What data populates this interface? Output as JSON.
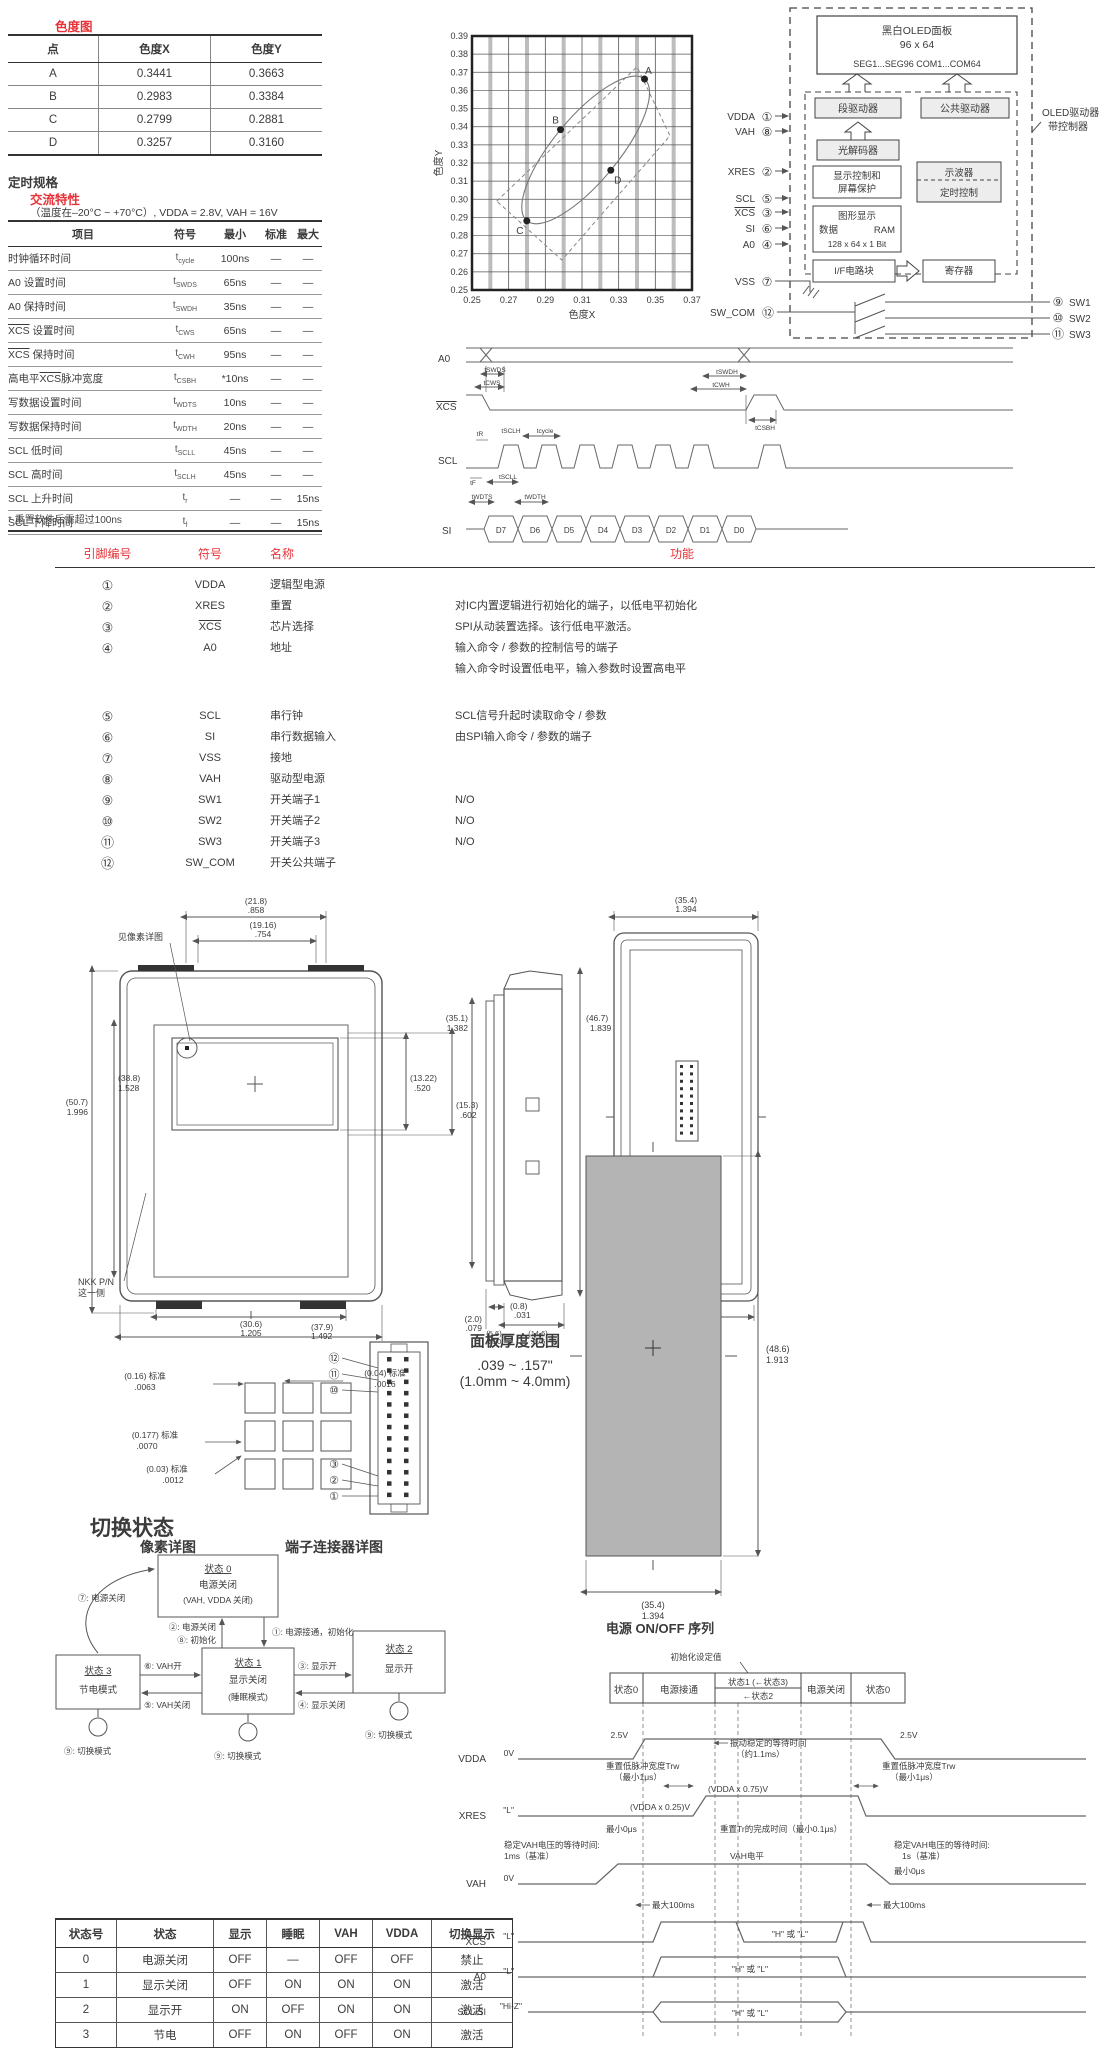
{
  "colors": {
    "accent_red": "#e63238",
    "text": "#3b3b3b",
    "panel_gray": "#b4b4b4"
  },
  "chroma": {
    "title": "色度图",
    "table": {
      "headers": [
        "点",
        "色度X",
        "色度Y"
      ],
      "rows": [
        [
          "A",
          "0.3441",
          "0.3663"
        ],
        [
          "B",
          "0.2983",
          "0.3384"
        ],
        [
          "C",
          "0.2799",
          "0.2881"
        ],
        [
          "D",
          "0.3257",
          "0.3160"
        ]
      ]
    }
  },
  "chart_data": {
    "type": "scatter",
    "title": "",
    "xlabel": "色度X",
    "ylabel": "色度Y",
    "xlim": [
      0.25,
      0.37
    ],
    "ylim": [
      0.25,
      0.39
    ],
    "x_tick_labels": [
      "0.25",
      "0.27",
      "0.29",
      "0.31",
      "0.33",
      "0.35",
      "0.37"
    ],
    "y_tick_start": 0.25,
    "y_tick_step": 0.01,
    "y_tick_count": 15,
    "grid": true,
    "legend": false,
    "points": [
      {
        "label": "A",
        "x": 0.3441,
        "y": 0.3663
      },
      {
        "label": "B",
        "x": 0.2983,
        "y": 0.3384
      },
      {
        "label": "C",
        "x": 0.2799,
        "y": 0.2881
      },
      {
        "label": "D",
        "x": 0.3257,
        "y": 0.316
      }
    ],
    "dashed_region": [
      [
        0.2635,
        0.299
      ],
      [
        0.34,
        0.373
      ],
      [
        0.358,
        0.335
      ],
      [
        0.299,
        0.2665
      ]
    ]
  },
  "timing": {
    "heading": "定时规格",
    "subheading": "交流特性",
    "condition": "（温度在–20°C ~ +70°C）, VDDA = 2.8V, VAH = 16V",
    "headers": [
      "项目",
      "符号",
      "最小",
      "标准",
      "最大"
    ],
    "rows": [
      {
        "item": "时钟循环时间",
        "sym": [
          "t",
          "cycle"
        ],
        "min": "100ns",
        "std": "—",
        "max": "—"
      },
      {
        "item": "A0 设置时间",
        "sym": [
          "t",
          "SWDS"
        ],
        "min": "65ns",
        "std": "—",
        "max": "—"
      },
      {
        "item": "A0 保持时间",
        "sym": [
          "t",
          "SWDH"
        ],
        "min": "35ns",
        "std": "—",
        "max": "—"
      },
      {
        "item": "{XCS} 设置时间",
        "sym": [
          "t",
          "CWS"
        ],
        "min": "65ns",
        "std": "—",
        "max": "—"
      },
      {
        "item": "{XCS} 保持时间",
        "sym": [
          "t",
          "CWH"
        ],
        "min": "95ns",
        "std": "—",
        "max": "—"
      },
      {
        "item": "高电平{XCS}脉冲宽度",
        "sym": [
          "t",
          "CSBH"
        ],
        "min": "*10ns",
        "std": "—",
        "max": "—"
      },
      {
        "item": "写数据设置时间",
        "sym": [
          "t",
          "WDTS"
        ],
        "min": "10ns",
        "std": "—",
        "max": "—"
      },
      {
        "item": "写数据保持时间",
        "sym": [
          "t",
          "WDTH"
        ],
        "min": "20ns",
        "std": "—",
        "max": "—"
      },
      {
        "item": "SCL 低时间",
        "sym": [
          "t",
          "SCLL"
        ],
        "min": "45ns",
        "std": "—",
        "max": "—"
      },
      {
        "item": "SCL 高时间",
        "sym": [
          "t",
          "SCLH"
        ],
        "min": "45ns",
        "std": "—",
        "max": "—"
      },
      {
        "item": "SCL 上升时间",
        "sym": [
          "t",
          "r"
        ],
        "min": "—",
        "std": "—",
        "max": "15ns"
      },
      {
        "item": "SCL 下降时间",
        "sym": [
          "t",
          "f"
        ],
        "min": "—",
        "std": "—",
        "max": "15ns"
      }
    ],
    "footnote": "* 重置软件后需超过100ns"
  },
  "waveform": {
    "sig": {
      "a0": "A0",
      "xcs": "XCS",
      "scl": "SCL",
      "si": "SI"
    },
    "t": {
      "swds": "tSWDS",
      "cws": "tCWS",
      "swdh": "tSWDH",
      "cwh": "tCWH",
      "csbh": "tCSBH",
      "tr": "tR",
      "sclh": "tSCLH",
      "tcycle": "tcycle",
      "tf": "tF",
      "scll": "tSCLL",
      "wdts": "tWDTS",
      "wdth": "tWDTH"
    },
    "data": [
      "D7",
      "D6",
      "D5",
      "D4",
      "D3",
      "D2",
      "D1",
      "D0"
    ]
  },
  "block": {
    "panel1": "黑白OLED面板",
    "panel2": "96 x 64",
    "panel3": "SEG1...SEG96   COM1...COM64",
    "seg": "段驱动器",
    "com": "公共驱动器",
    "dec": "光解码器",
    "dc1": "显示控制和",
    "dc2": "屏幕保护",
    "osc": "示波器",
    "tc": "定时控制",
    "ram1": "图形显示",
    "ram2a": "数据",
    "ram2b": "RAM",
    "ram3": "128 x 64 x 1 Bit",
    "ifb": "I/F电路块",
    "reg": "寄存器",
    "ctrl1": "OLED驱动器",
    "ctrl2": "带控制器",
    "pins": {
      "vdda": "VDDA",
      "n1": "①",
      "vah": "VAH",
      "n8": "⑧",
      "xres": "XRES",
      "n2": "②",
      "scl": "SCL",
      "n5": "⑤",
      "xcs": "XCS",
      "n3": "③",
      "si": "SI",
      "n6": "⑥",
      "a0": "A0",
      "n4": "④",
      "vss": "VSS",
      "n7": "⑦",
      "swcom": "SW_COM",
      "n12": "⑫",
      "n9": "⑨",
      "sw1": "SW1",
      "n10": "⑩",
      "sw2": "SW2",
      "n11": "⑪",
      "sw3": "SW3"
    }
  },
  "pins": {
    "headers": [
      "引脚编号",
      "符号",
      "名称",
      "功能"
    ],
    "rows": [
      {
        "num": "①",
        "sym": "VDDA",
        "ovl": false,
        "name": "逻辑型电源",
        "func": []
      },
      {
        "num": "②",
        "sym": "XRES",
        "ovl": false,
        "name": "重置",
        "func": [
          "对IC内置逻辑进行初始化的端子，以低电平初始化"
        ]
      },
      {
        "num": "③",
        "sym": "XCS",
        "ovl": true,
        "name": "芯片选择",
        "func": [
          "SPI从动装置选择。该行低电平激活。"
        ]
      },
      {
        "num": "④",
        "sym": "A0",
        "ovl": false,
        "name": "地址",
        "func": [
          "输入命令 / 参数的控制信号的端子",
          "输入命令时设置低电平，输入参数时设置高电平"
        ]
      },
      {
        "num": "⑤",
        "sym": "SCL",
        "ovl": false,
        "name": "串行钟",
        "func": [
          "SCL信号升起时读取命令 / 参数"
        ],
        "gap": true
      },
      {
        "num": "⑥",
        "sym": "SI",
        "ovl": false,
        "name": "串行数据输入",
        "func": [
          "由SPI输入命令 / 参数的端子"
        ]
      },
      {
        "num": "⑦",
        "sym": "VSS",
        "ovl": false,
        "name": "接地",
        "func": []
      },
      {
        "num": "⑧",
        "sym": "VAH",
        "ovl": false,
        "name": "驱动型电源",
        "func": []
      },
      {
        "num": "⑨",
        "sym": "SW1",
        "ovl": false,
        "name": "开关端子1",
        "func": [
          "N/O"
        ]
      },
      {
        "num": "⑩",
        "sym": "SW2",
        "ovl": false,
        "name": "开关端子2",
        "func": [
          "N/O"
        ]
      },
      {
        "num": "⑪",
        "sym": "SW3",
        "ovl": false,
        "name": "开关端子3",
        "func": [
          "N/O"
        ]
      },
      {
        "num": "⑫",
        "sym": "SW_COM",
        "ovl": false,
        "name": "开关公共端子",
        "func": []
      }
    ]
  },
  "mech": {
    "top1": [
      "(21.8)",
      ".858"
    ],
    "top2": [
      "(19.16)",
      ".754"
    ],
    "see_pixel": "见像素详图",
    "left1": [
      "(50.7)",
      "1.996"
    ],
    "left2": [
      "(38.8)",
      "1.528"
    ],
    "right1": [
      "(13.22)",
      ".520"
    ],
    "right2": [
      "(15.3)",
      ".602"
    ],
    "bot1": [
      "(30.6)",
      "1.205"
    ],
    "bot2": [
      "(37.9)",
      "1.492"
    ],
    "nkk1": "NKK P/N",
    "nkk2": "这一侧",
    "sleft": [
      "(35.1)",
      "1.382"
    ],
    "sright": [
      "(46.7)",
      "1.839"
    ],
    "sb1": [
      "(0.8)",
      ".031"
    ],
    "sb2": [
      "(2.0)",
      ".079"
    ],
    "sb3": [
      "(5.6)",
      ".220"
    ],
    "sb4": [
      "(14.6)",
      ".575"
    ],
    "btop": [
      "(35.4)",
      "1.394"
    ],
    "bbot": [
      "(34.9)",
      "1.374"
    ]
  },
  "pixel": {
    "d1a": "(0.16) 标准",
    "d1b": ".0063",
    "d2a": "(0.04) 标准",
    "d2b": ".0016",
    "d3a": "(0.177) 标准",
    "d3b": ".0070",
    "d4a": "(0.03) 标准",
    "d4b": ".0012",
    "caption": "像素详图"
  },
  "connector": {
    "n12": "⑫",
    "n11": "⑪",
    "n10": "⑩",
    "n3": "③",
    "n2": "②",
    "n1": "①",
    "caption": "端子连接器详图"
  },
  "thickness": {
    "title": "面板厚度范围",
    "line1": ".039 ~ .157\"",
    "line2": "(1.0mm ~ 4.0mm)",
    "right1": "(48.6)",
    "right2": "1.913",
    "bot1": "(35.4)",
    "bot2": "1.394"
  },
  "power": {
    "caption": "电源 ON/OFF 序列",
    "init": "初始化设定值",
    "h": [
      "状态0",
      "电源接通",
      "状态1 (←状态3)",
      "←状态2",
      "电源关闭",
      "状态0"
    ],
    "sig": {
      "vdda": "VDDA",
      "xres": "XRES",
      "vah": "VAH",
      "xcs": "XCS",
      "a0": "A0",
      "sclsi": "SCL/SI"
    },
    "lvl": {
      "v25l": "2.5V",
      "v25r": "2.5V",
      "v0a": "0V",
      "v0b": "0V",
      "l1": "\"L\"",
      "l2": "\"L\"",
      "l3": "\"L\"",
      "hiz": "\"Hi-Z\"",
      "hl": "\"H\" 或 \"L\""
    },
    "ann": {
      "osc1": "振动稳定的等待时间",
      "osc2": "（约1.1ms）",
      "trwl1": "重置低脉冲宽度Trw",
      "trwl2": "（最小1μs）",
      "trwr1": "重置低脉冲宽度Trw",
      "trwr2": "（最小1μs）",
      "v075": "(VDDA x 0.75)V",
      "v025": "(VDDA x 0.25)V",
      "min0a": "最小0μs",
      "trdone": "重置Tr的完成时间（最小0.1μs）",
      "vwl1": "稳定VAH电压的等待时间:",
      "vwl2": "1ms（基准）",
      "vlvl": "VAH电平",
      "vwr1": "稳定VAH电压的等待时间:",
      "vwr2": "1s（基准）",
      "min0b": "最小0μs",
      "max1": "最大100ms",
      "max2": "最大100ms"
    }
  },
  "states": {
    "title": "切换状态",
    "s0": [
      "状态 0",
      "电源关闭",
      "(VAH, VDDA 关闭)"
    ],
    "s1": [
      "状态 1",
      "显示关闭",
      "(睡眠模式)"
    ],
    "s2": [
      "状态 2",
      "显示开"
    ],
    "s3": [
      "状态 3",
      "节电模式"
    ],
    "t1": "①: 电源接通，初始化",
    "t2": "②: 电源关闭",
    "t3": "③: 显示开",
    "t4": "④: 显示关闭",
    "t5": "⑤: VAH关闭",
    "t6": "⑥: VAH开",
    "t7": "⑦: 电源关闭",
    "t8": "⑧: 初始化",
    "t9": "⑨: 切换模式",
    "table": {
      "headers": [
        "状态号",
        "状态",
        "显示",
        "睡眠",
        "VAH",
        "VDDA",
        "切换显示"
      ],
      "rows": [
        [
          "0",
          "电源关闭",
          "OFF",
          "—",
          "OFF",
          "OFF",
          "禁止"
        ],
        [
          "1",
          "显示关闭",
          "OFF",
          "ON",
          "ON",
          "ON",
          "激活"
        ],
        [
          "2",
          "显示开",
          "ON",
          "OFF",
          "ON",
          "ON",
          "激活"
        ],
        [
          "3",
          "节电",
          "OFF",
          "ON",
          "OFF",
          "ON",
          "激活"
        ]
      ]
    }
  }
}
